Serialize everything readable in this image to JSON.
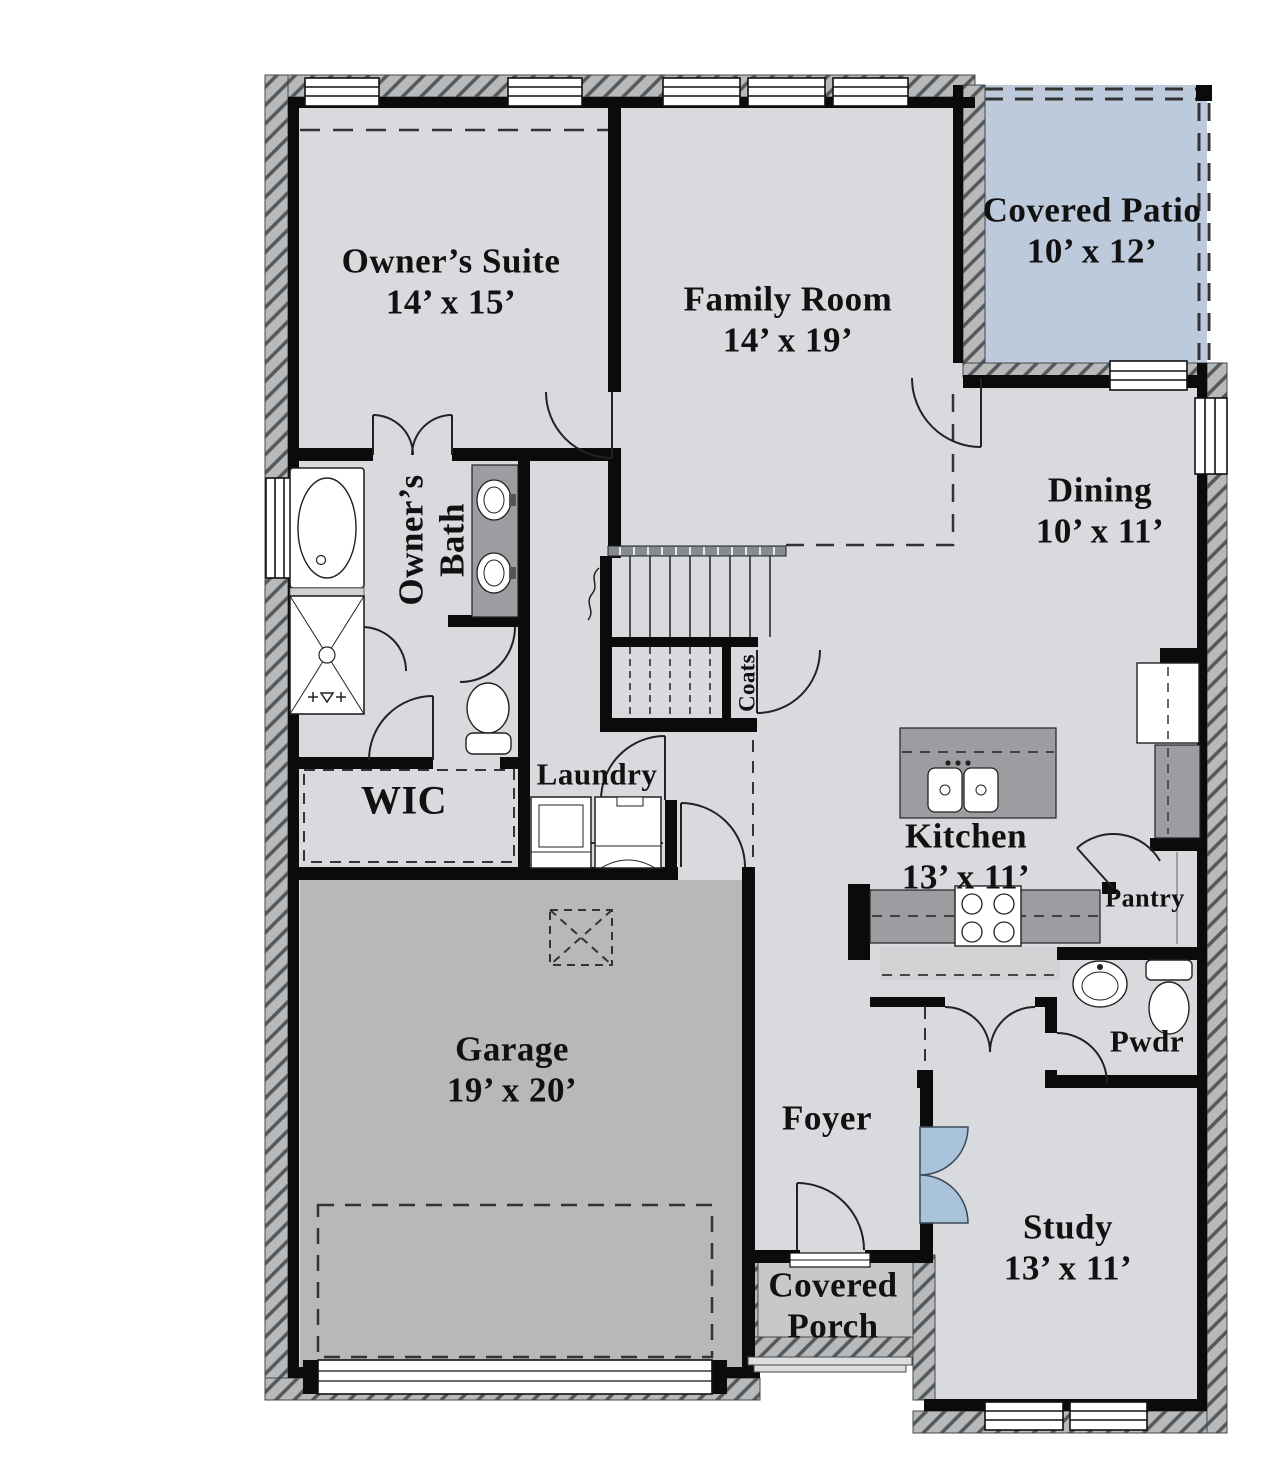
{
  "plan_title": "First Floor Plan",
  "rooms": {
    "owners_suite": {
      "name": "Owner’s Suite",
      "dims": "14’ x 15’"
    },
    "family_room": {
      "name": "Family Room",
      "dims": "14’ x 19’"
    },
    "covered_patio": {
      "name": "Covered Patio",
      "dims": "10’ x 12’"
    },
    "dining": {
      "name": "Dining",
      "dims": "10’ x 11’"
    },
    "owners_bath": {
      "name": "Owner’s Bath"
    },
    "wic": {
      "name": "WIC"
    },
    "laundry": {
      "name": "Laundry"
    },
    "coats": {
      "name": "Coats"
    },
    "kitchen": {
      "name": "Kitchen",
      "dims": "13’ x 11’"
    },
    "pantry": {
      "name": "Pantry"
    },
    "garage": {
      "name": "Garage",
      "dims": "19’ x 20’"
    },
    "foyer": {
      "name": "Foyer"
    },
    "pwdr": {
      "name": "Pwdr"
    },
    "study": {
      "name": "Study",
      "dims": "13’ x 11’"
    },
    "covered_porch": {
      "name": "Covered Porch"
    }
  },
  "fixtures": [
    "bathtub",
    "shower",
    "double-vanity-sinks",
    "toilet",
    "washer",
    "dryer",
    "kitchen-island-sink",
    "range",
    "refrigerator",
    "staircase",
    "attic-access",
    "garage-door",
    "french-doors",
    "front-door"
  ],
  "colors": {
    "floor": "#d8dade",
    "garage_floor": "#b6b8ba",
    "patio_floor": "#bccadb",
    "porch_floor": "#c6c8ca",
    "counter": "#9b9da0",
    "wall": "#0b0b0b",
    "glass_door": "#a9c3da",
    "hatch_band": "#b7b9bb"
  }
}
